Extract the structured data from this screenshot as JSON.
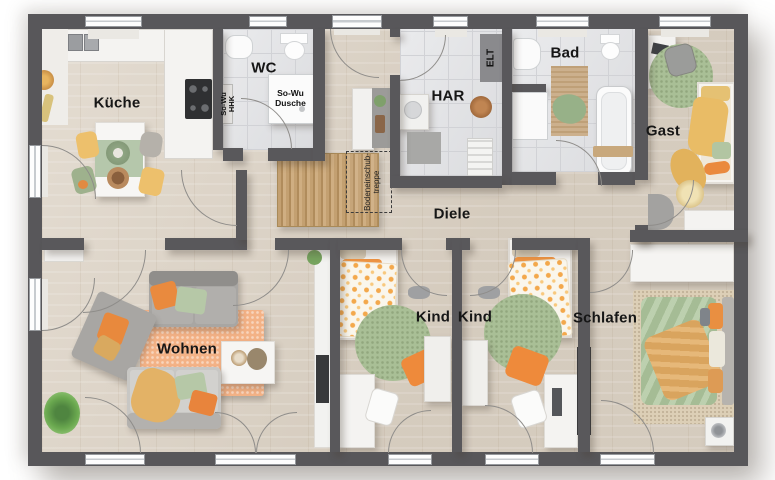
{
  "labels": {
    "kueche": "Küche",
    "wc": "WC",
    "har": "HAR",
    "bad": "Bad",
    "gast": "Gast",
    "diele": "Diele",
    "wohnen": "Wohnen",
    "kind1": "Kind",
    "kind2": "Kind",
    "schlafen": "Schlafen"
  },
  "annotations": {
    "dusche_l1": "So-Wu",
    "dusche_l2": "Dusche",
    "hhk_l1": "So-Wu",
    "hhk_l2": "HHK",
    "elt": "ELT",
    "treppe_l1": "Bodeneinschub-",
    "treppe_l2": "treppe"
  },
  "colors": {
    "wall": "#58575a",
    "wood_floor": "#dcd2c4",
    "tile_floor": "#dfe0e3",
    "accent_orange": "#ec8c3f",
    "accent_green": "#aec29b",
    "accent_yellow": "#e8bd6e",
    "rug_orange": "#f3b286",
    "rug_jute": "#c3a071",
    "furniture_white": "#f4f3f1",
    "sofa_gray": "#a8a6a3"
  }
}
